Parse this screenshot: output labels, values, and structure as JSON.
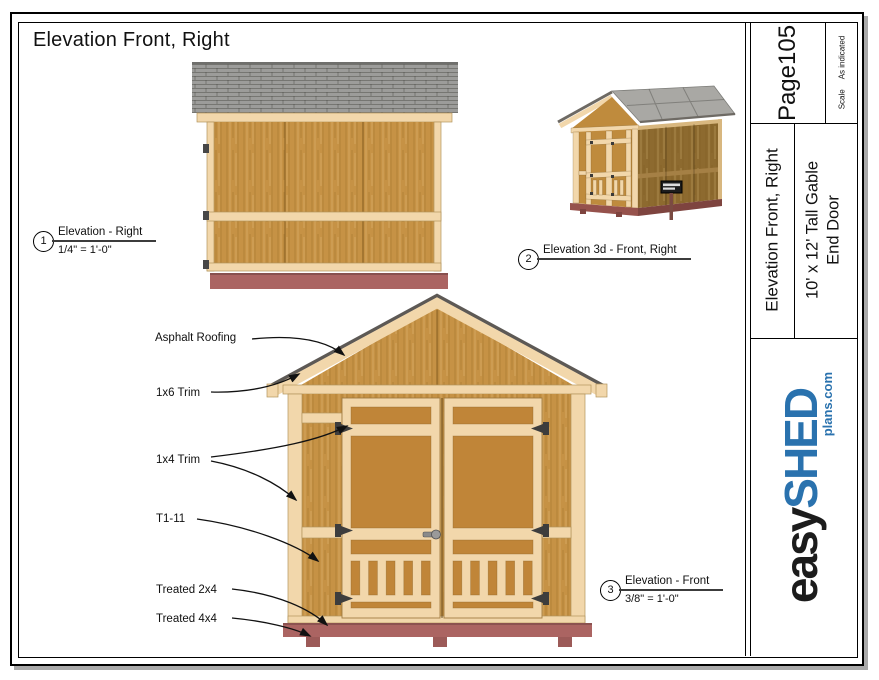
{
  "sheet_title": "Elevation Front, Right",
  "callouts": [
    {
      "num": "1",
      "title": "Elevation - Right",
      "scale": "1/4\" = 1'-0\""
    },
    {
      "num": "2",
      "title": "Elevation 3d - Front, Right",
      "scale": ""
    },
    {
      "num": "3",
      "title": "Elevation - Front",
      "scale": "3/8\" = 1'-0\""
    }
  ],
  "annotations": [
    {
      "label": "Asphalt Roofing"
    },
    {
      "label": "1x6 Trim"
    },
    {
      "label": "1x4 Trim"
    },
    {
      "label": "T1-11"
    },
    {
      "label": "Treated 2x4"
    },
    {
      "label": "Treated 4x4"
    }
  ],
  "title_block": {
    "page": "Page105",
    "scale_label": "Scale",
    "scale_value": "As indicated",
    "sheet_name": "Elevation Front, Right",
    "plan_line1": "10' x 12' Tall Gable",
    "plan_line2": "End Door",
    "logo_easy": "easy",
    "logo_shed": "SHED",
    "logo_domain": "plans.com"
  },
  "palette": {
    "trim": "#f2d7ab",
    "trim-line": "#b3945c",
    "wood": "#c69245",
    "door-wood": "#c08538",
    "roof-gray": "#9c9c9a",
    "roof-3d": "#a9a8a4",
    "roof-edge": "#5d5955",
    "base-red": "#ab6462",
    "base-red-dark": "#9c5a58",
    "front-3d": "#bf8b3d",
    "side-3d": "#8d6a2f",
    "logo-blue": "#2a72ae",
    "ink": "#111111"
  }
}
